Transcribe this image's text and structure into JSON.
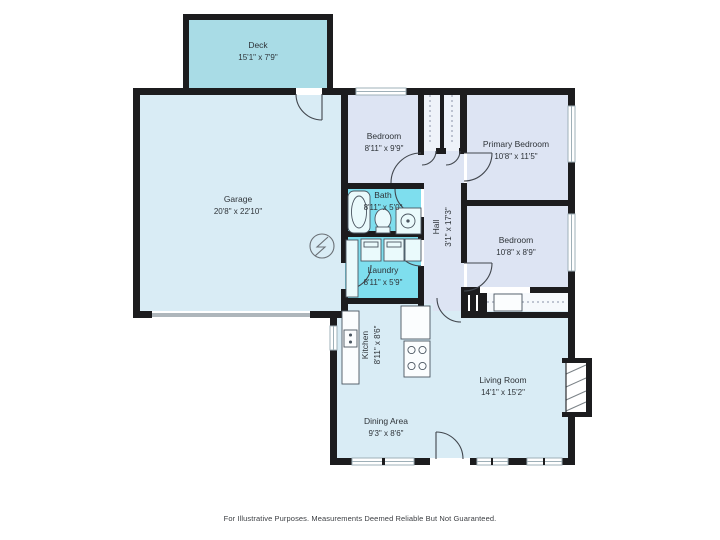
{
  "page": {
    "disclaimer": "For Illustrative Purposes. Measurements Deemed Reliable But Not Guaranteed."
  },
  "palette": {
    "wall": "#1c1c1e",
    "deck": "#a9dce6",
    "common": "#d9ecf5",
    "bedroom": "#dde4f3",
    "wet": "#7edeee",
    "closet": "#eef2f9",
    "text": "#2e3338"
  },
  "symbols": {
    "electrical_panel": "lightning-bolt-in-circle"
  },
  "rooms": {
    "deck": {
      "name": "Deck",
      "dims": "15'1\" x 7'9\""
    },
    "garage": {
      "name": "Garage",
      "dims": "20'8\" x 22'10\""
    },
    "bedroom_top": {
      "name": "Bedroom",
      "dims": "8'11\" x 9'9\""
    },
    "primary_bedroom": {
      "name": "Primary Bedroom",
      "dims": "10'8\" x 11'5\""
    },
    "bath": {
      "name": "Bath",
      "dims": "8'11\" x 5'0\""
    },
    "hall": {
      "name": "Hall",
      "dims": "3'1\" x 17'3\""
    },
    "bedroom_right": {
      "name": "Bedroom",
      "dims": "10'8\" x 8'9\""
    },
    "laundry": {
      "name": "Laundry",
      "dims": "8'11\" x 5'9\""
    },
    "kitchen": {
      "name": "Kitchen",
      "dims": "8'11\" x 8'6\""
    },
    "living_room": {
      "name": "Living Room",
      "dims": "14'1\" x 15'2\""
    },
    "dining_area": {
      "name": "Dining Area",
      "dims": "9'3\" x 8'6\""
    }
  }
}
